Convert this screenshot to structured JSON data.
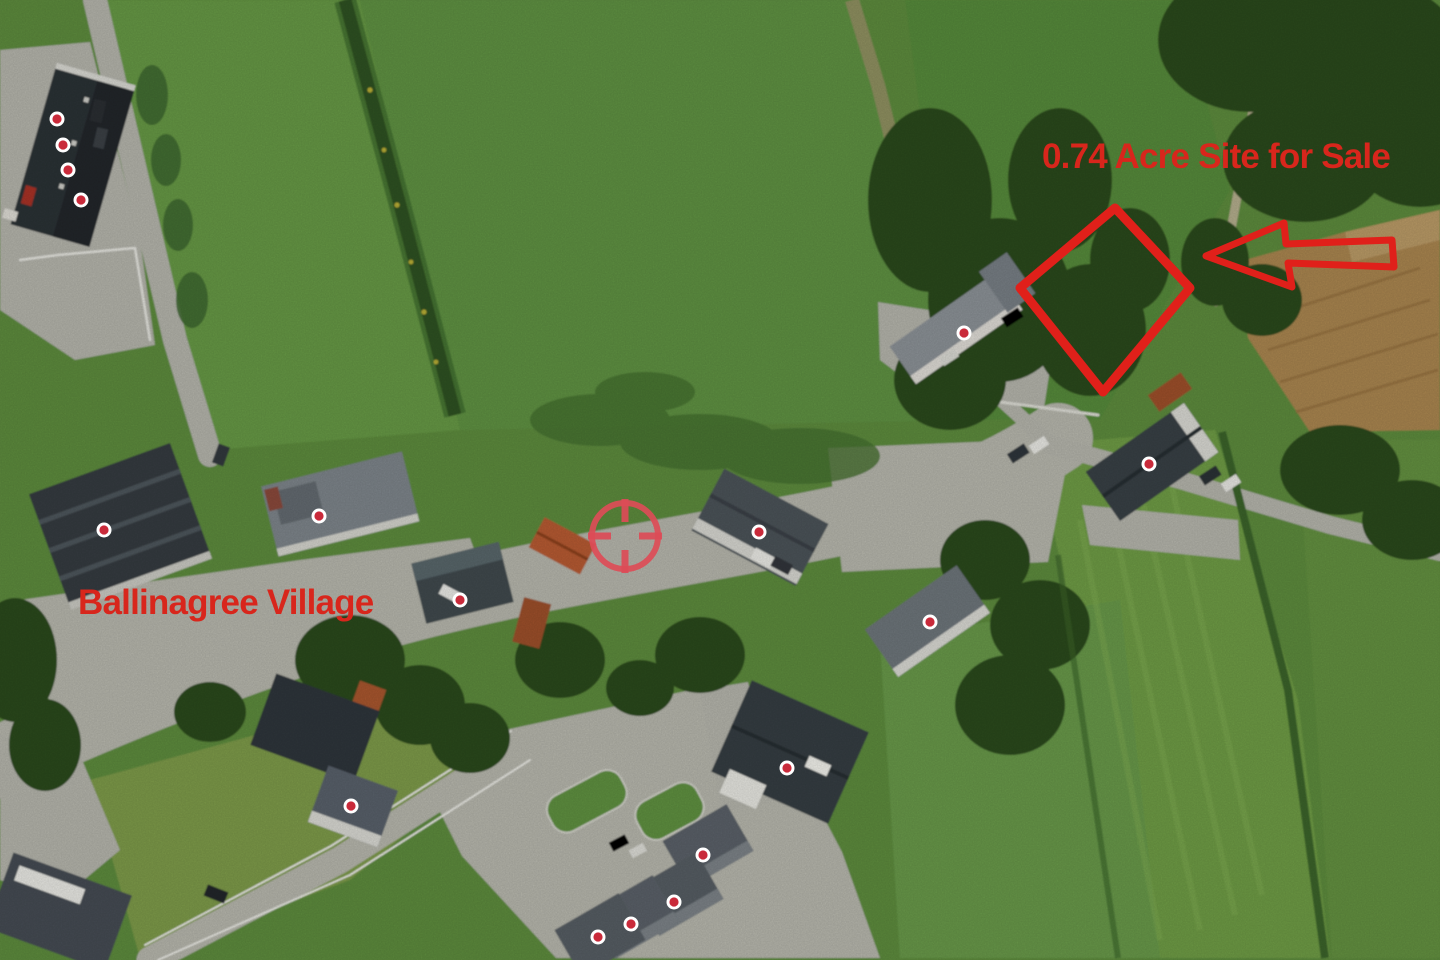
{
  "meta": {
    "description": "Annotated aerial photograph of a village with a site for sale"
  },
  "palette": {
    "annotation_red": "#d8261c",
    "outline_red": "#e0201a",
    "marker_dot": "#c92a3a",
    "marker_ring": "#ffffff",
    "crosshair_red": "#dd4c57"
  },
  "labels": {
    "site": {
      "text": "0.74 Acre Site for Sale",
      "x": 1042,
      "y": 168,
      "font_size": 35,
      "color": "#d8261c"
    },
    "village": {
      "text": "Ballinagree Village",
      "x": 78,
      "y": 614,
      "font_size": 35,
      "color": "#d8261c"
    }
  },
  "annotations": {
    "site_outline": {
      "shape": "diamond",
      "points": "1115,208 1190,288 1103,392 1020,288",
      "stroke_width": 9,
      "color": "#e0201a"
    },
    "arrow": {
      "direction": "left",
      "points": "1206,256 1284,223 1286,244 1392,240 1394,267 1288,263 1292,287",
      "stroke_width": 7,
      "color": "#e0201a"
    },
    "crosshair": {
      "cx": 625,
      "cy": 536,
      "outer_radius": 33,
      "tick_outer": 37,
      "tick_inner": 14,
      "stroke_width": 6,
      "tick_width": 7,
      "color": "#dd4c57"
    },
    "markers": {
      "ring_color": "#ffffff",
      "dot_color": "#c92a3a",
      "ring_radius": 7.5,
      "dot_radius": 4.6,
      "points": [
        [
          57,
          119
        ],
        [
          63,
          145
        ],
        [
          68,
          170
        ],
        [
          81,
          200
        ],
        [
          104,
          530
        ],
        [
          319,
          516
        ],
        [
          460,
          600
        ],
        [
          759,
          532
        ],
        [
          964,
          333
        ],
        [
          1149,
          464
        ],
        [
          930,
          622
        ],
        [
          351,
          806
        ],
        [
          787,
          768
        ],
        [
          703,
          855
        ],
        [
          674,
          902
        ],
        [
          631,
          924
        ],
        [
          598,
          937
        ]
      ]
    }
  }
}
